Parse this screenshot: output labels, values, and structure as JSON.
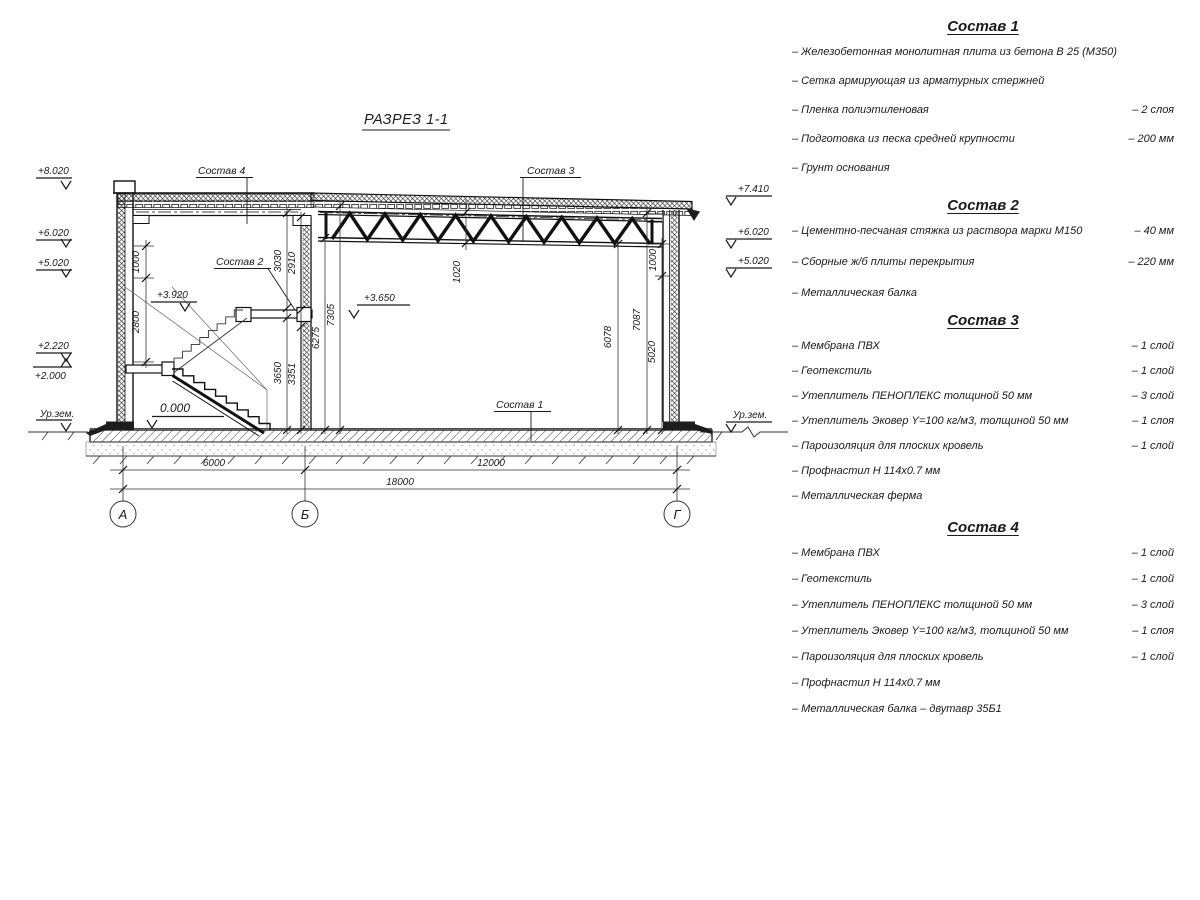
{
  "drawing": {
    "title": "РАЗРЕЗ 1-1",
    "leaders": {
      "l4": "Состав 4",
      "l3": "Состав 3",
      "l2": "Состав 2",
      "l1": "Состав 1"
    },
    "marks": {
      "m8020": "+8.020",
      "m6020l": "+6.020",
      "m5020l": "+5.020",
      "m2220": "+2.220",
      "m2000": "+2.000",
      "urzem_l": "Ур.зем.",
      "m0000": "0.000",
      "m3920": "+3.920",
      "m3650": "+3.650",
      "m7410": "+7.410",
      "m6020r": "+6.020",
      "m5020r": "+5.020",
      "urzem_r": "Ур.зем."
    },
    "dims": {
      "left_1000": "1000",
      "left_2800": "2800",
      "mid_3030": "3030",
      "mid_2910": "2910",
      "mid_3650": "3650",
      "mid_3351": "3351",
      "mid_6275": "6275",
      "mid_7305": "7305",
      "truss_1020": "1020",
      "right_6078": "6078",
      "right_7087": "7087",
      "right_1000": "1000",
      "right_5020": "5020",
      "span_ab": "6000",
      "span_bg": "12000",
      "span_total": "18000"
    },
    "axes": {
      "a": "А",
      "b": "Б",
      "g": "Г"
    }
  },
  "compositions": [
    {
      "title": "Состав 1",
      "items": [
        {
          "label": "– Железобетонная  монолитная плита из бетона В 25 (М350)",
          "value": ""
        },
        {
          "label": "– Сетка армирующая из арматурных стержней",
          "value": ""
        },
        {
          "label": "– Пленка полиэтиленовая",
          "value": "– 2 слоя"
        },
        {
          "label": "– Подготовка из песка средней крупности",
          "value": "– 200 мм"
        },
        {
          "label": "– Грунт основания",
          "value": ""
        }
      ]
    },
    {
      "title": "Состав 2",
      "items": [
        {
          "label": "– Цементно-песчаная стяжка из раствора марки М150",
          "value": "– 40 мм"
        },
        {
          "label": "– Сборные ж/б плиты перекрытия",
          "value": "– 220 мм"
        },
        {
          "label": "– Металлическая балка",
          "value": ""
        }
      ]
    },
    {
      "title": "Состав 3",
      "items": [
        {
          "label": "– Мембрана ПВХ",
          "value": "– 1 слой"
        },
        {
          "label": "– Геотекстиль",
          "value": "– 1 слой"
        },
        {
          "label": "– Утеплитель ПЕНОПЛЕКС толщиной 50 мм",
          "value": "– 3 слой"
        },
        {
          "label": "– Утеплитель Эковер Y=100 кг/м3, толщиной 50 мм",
          "value": "– 1 слоя"
        },
        {
          "label": "– Пароизоляция для плоских кровель",
          "value": "– 1 слой"
        },
        {
          "label": "– Профнастил Н 114х0.7 мм",
          "value": ""
        },
        {
          "label": "– Металлическая ферма",
          "value": ""
        }
      ]
    },
    {
      "title": "Состав 4",
      "items": [
        {
          "label": "– Мембрана ПВХ",
          "value": "– 1 слой"
        },
        {
          "label": "– Геотекстиль",
          "value": "– 1 слой"
        },
        {
          "label": "– Утеплитель ПЕНОПЛЕКС толщиной 50 мм",
          "value": "– 3 слой"
        },
        {
          "label": "– Утеплитель Эковер Y=100 кг/м3, толщиной 50 мм",
          "value": "– 1 слоя"
        },
        {
          "label": "– Пароизоляция для плоских кровель",
          "value": "– 1 слой"
        },
        {
          "label": "– Профнастил Н 114х0.7 мм",
          "value": ""
        },
        {
          "label": "– Металлическая балка – двутавр 35Б1",
          "value": ""
        }
      ]
    }
  ]
}
